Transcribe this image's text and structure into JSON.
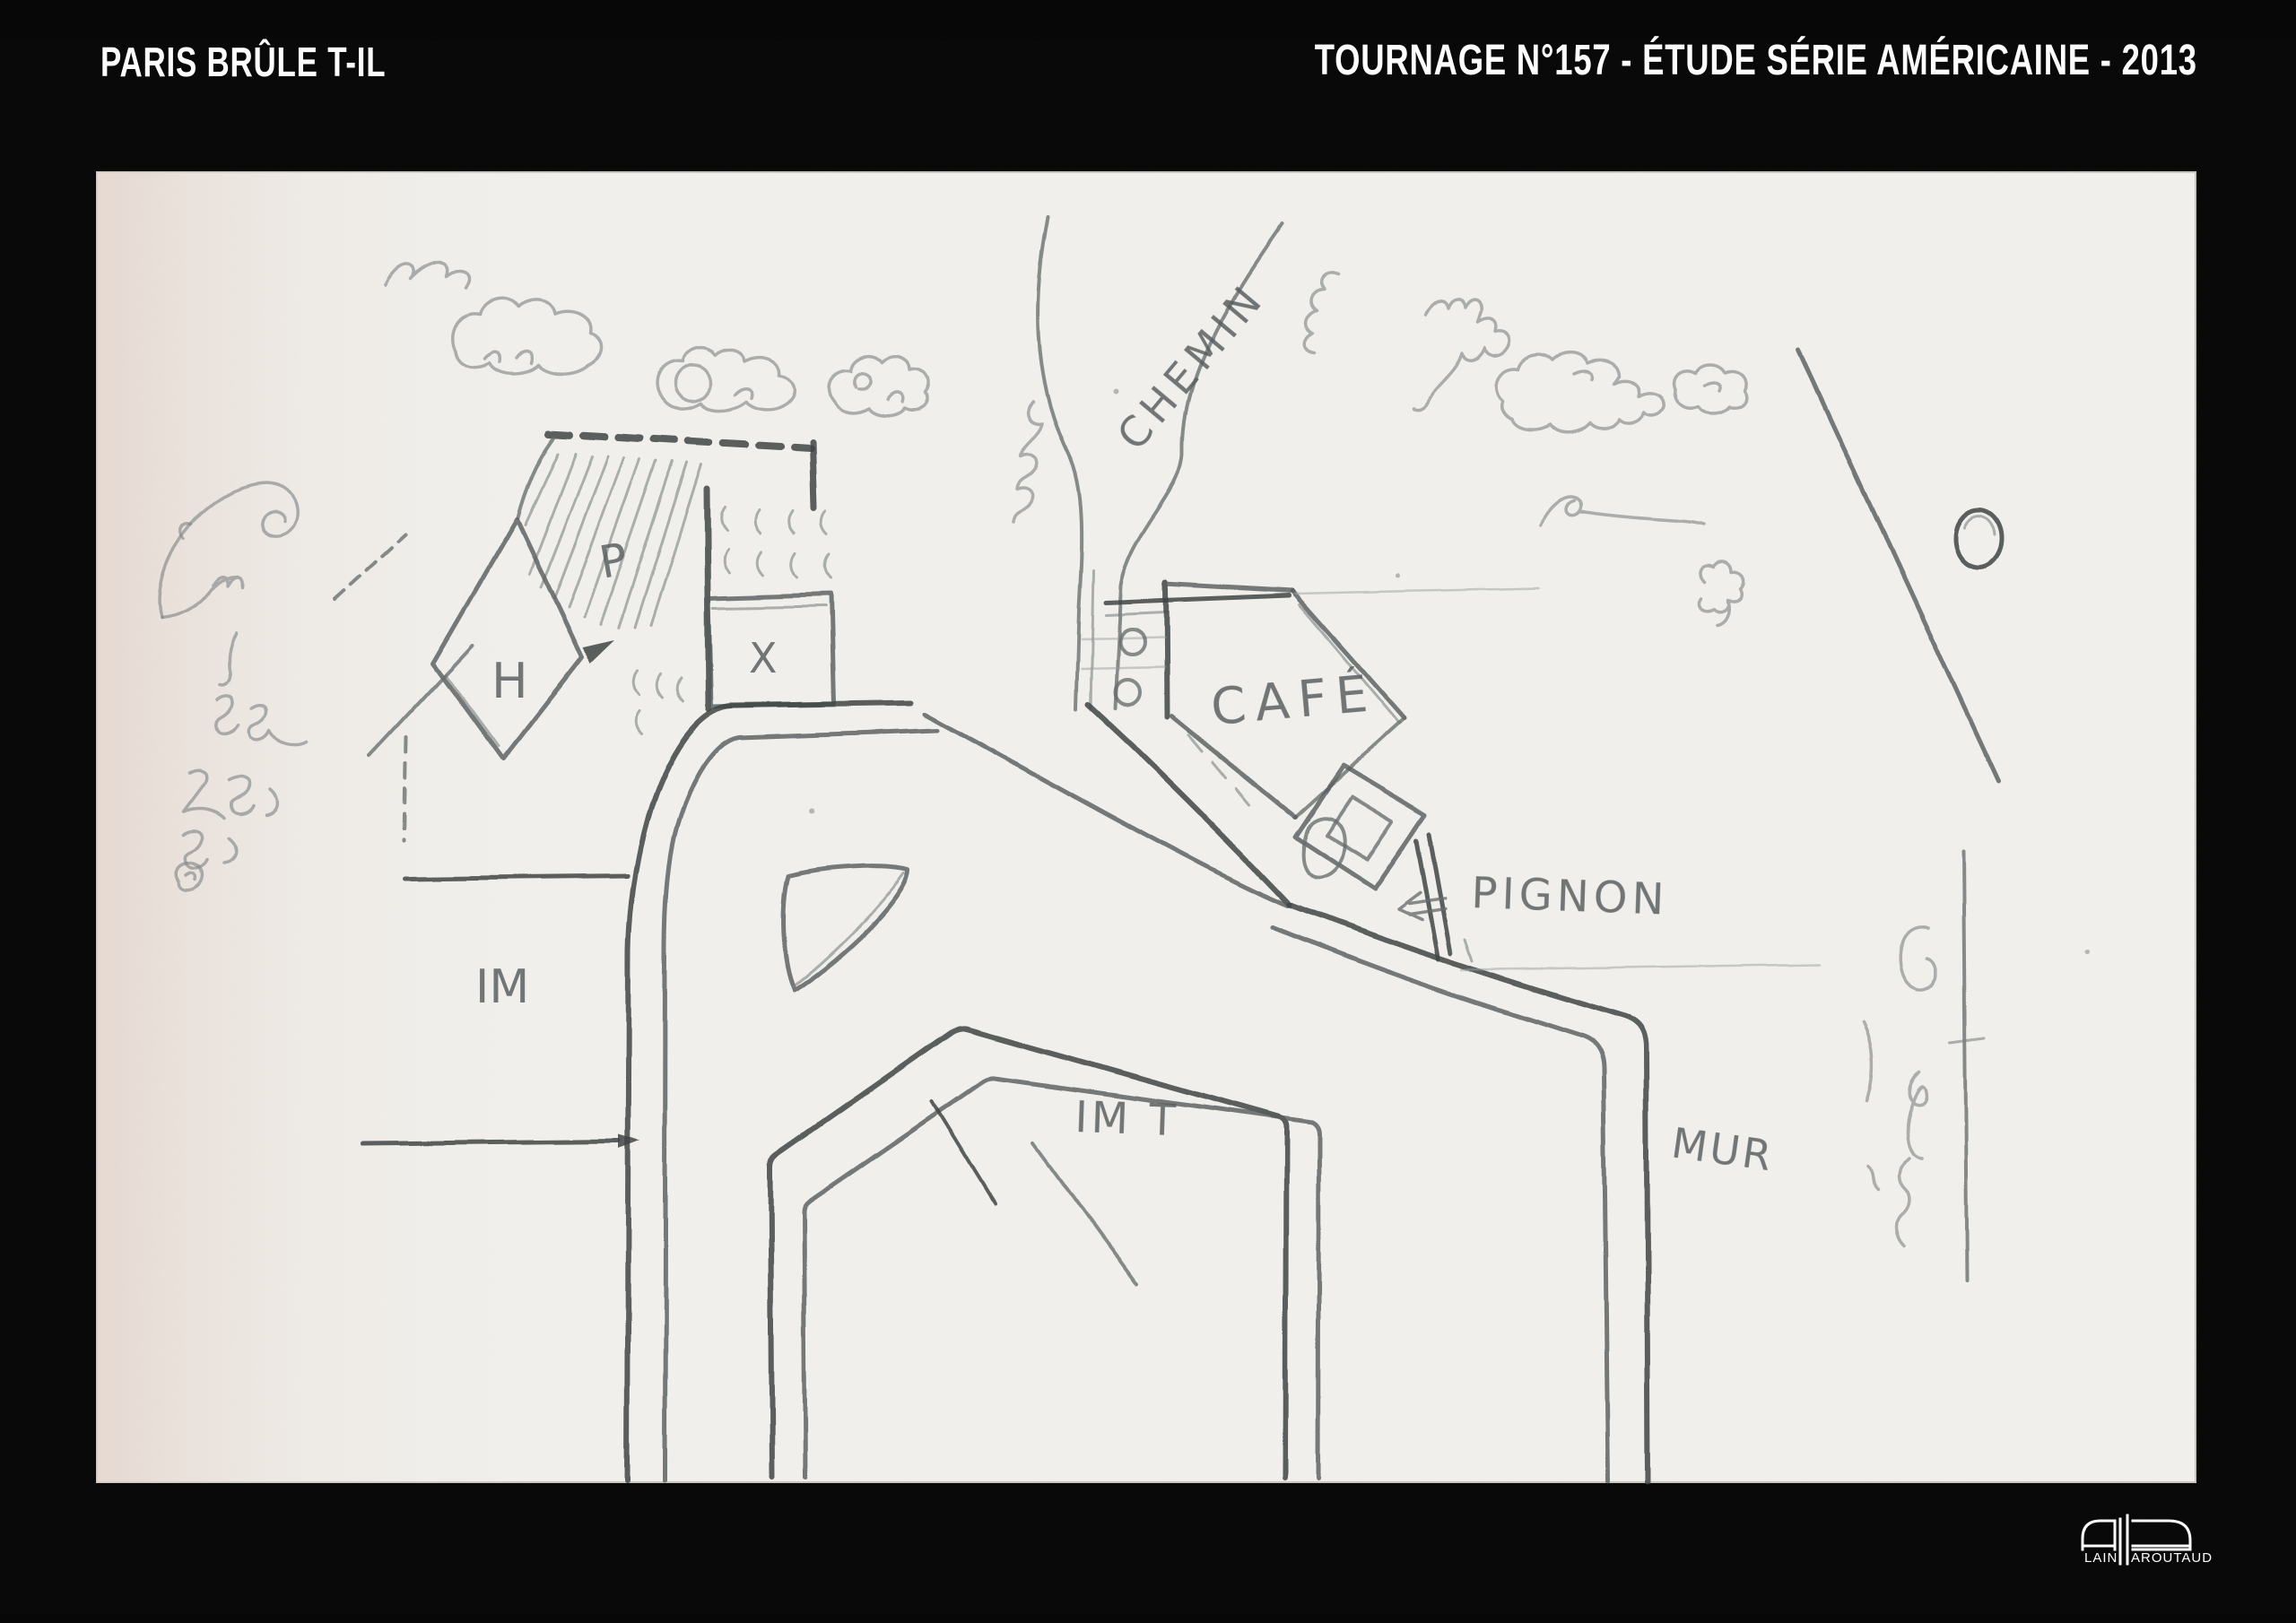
{
  "header": {
    "left_title": "PARIS BRÛLE T-IL",
    "right_title": "TOURNAGE N°157 - ÉTUDE SÉRIE AMÉRICAINE - 2013"
  },
  "sketch": {
    "labels": {
      "chemin": "CHEMIN",
      "cafe": "CAFÉ",
      "pignon": "PIGNON",
      "mur": "MUR",
      "im": "IM",
      "imt": "IM T",
      "h": "H",
      "p": "P",
      "x": "X"
    }
  },
  "logo": {
    "full_name": "ALAIN PAROUTAUD",
    "text_left": "LAIN",
    "text_right": "AROUTAUD"
  },
  "colors": {
    "frame_background": "#070707",
    "paper": "#f1f0ec",
    "paper_left_tint": "#e5d9d2",
    "pencil": "#676c6d",
    "pencil_dark": "#3f4445",
    "header_text": "#ffffff"
  }
}
